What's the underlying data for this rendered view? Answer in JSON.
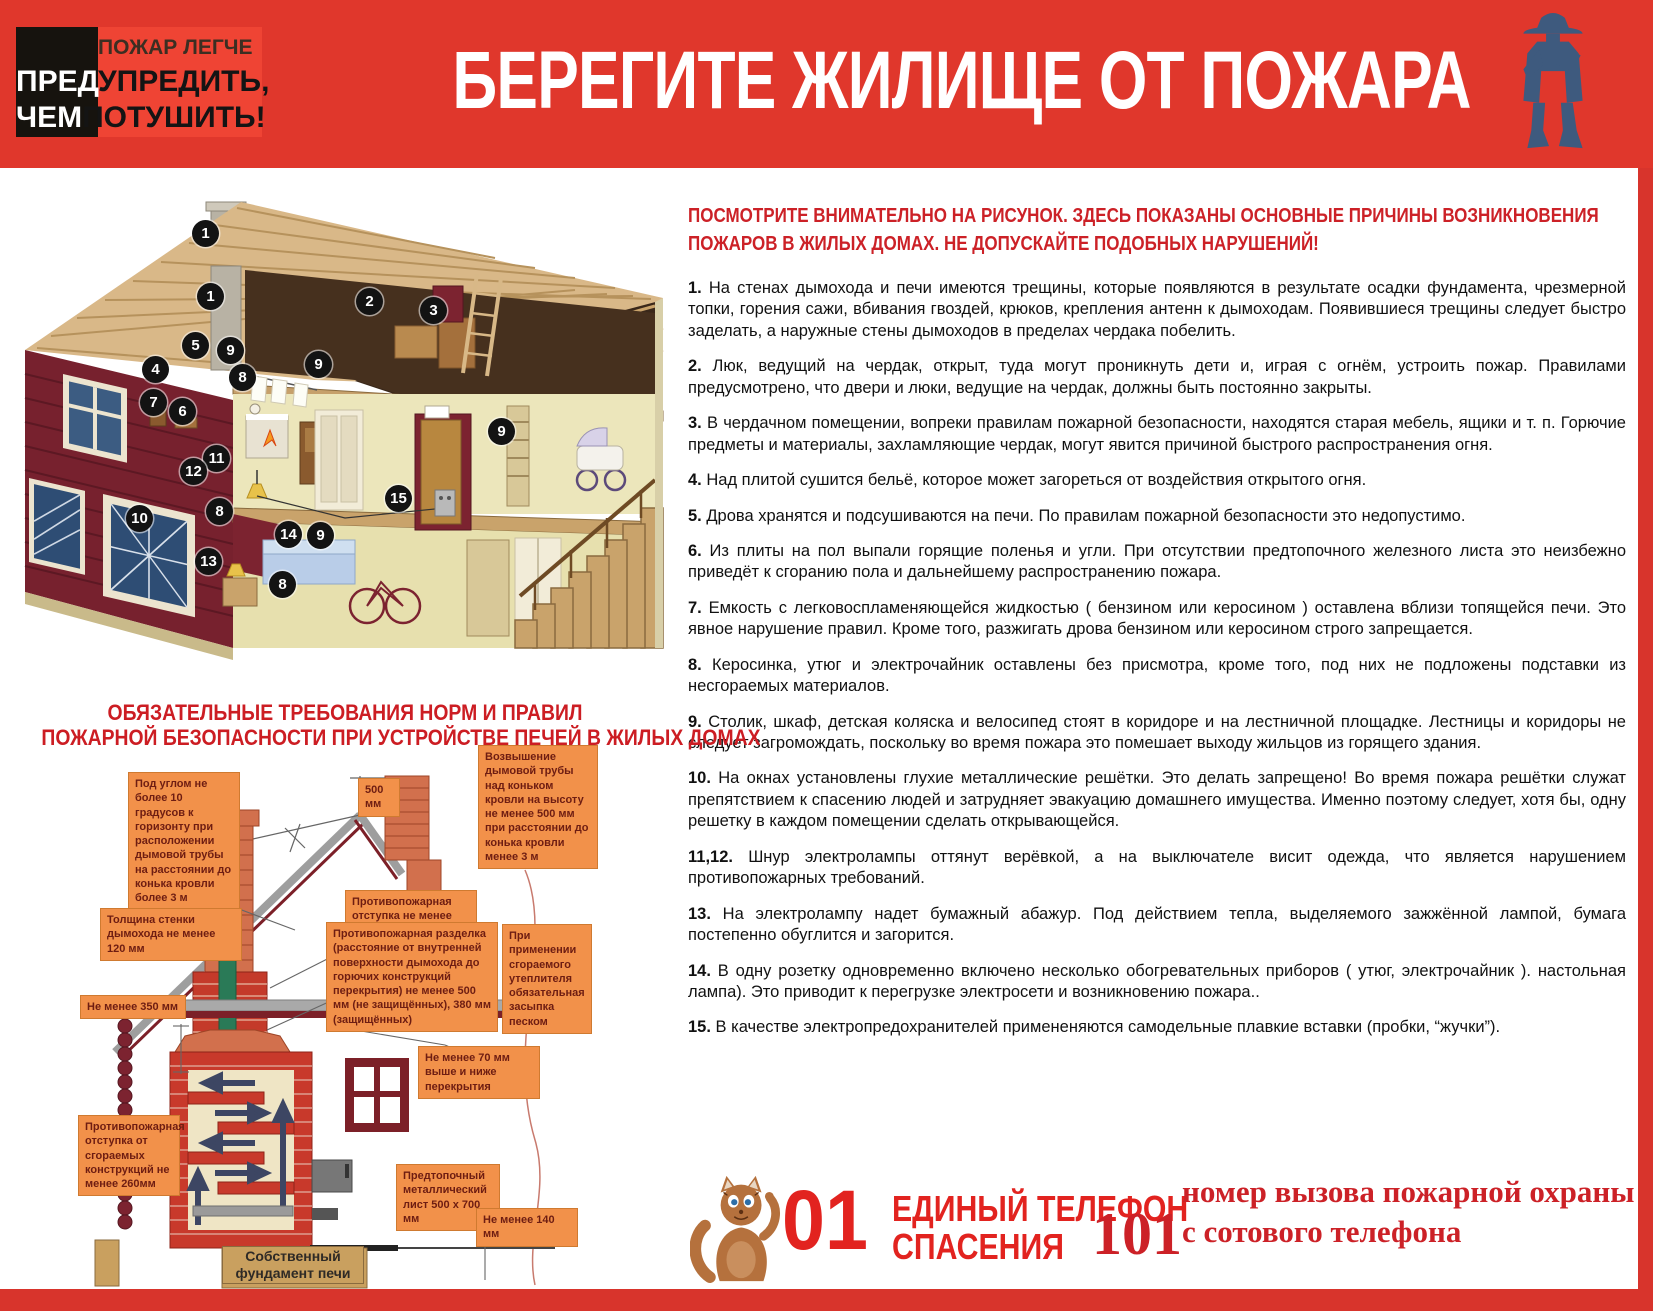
{
  "colors": {
    "header_red": "#e0372c",
    "accent_red": "#d8342c",
    "badge_light_red": "#ef4434",
    "badge_black": "#16130e",
    "heading_red": "#cc1d23",
    "callout_orange": "#f2914a",
    "callout_text": "#6e1d12",
    "firefighter_blue": "#3e5a7e",
    "mascot_brown": "#b5713d"
  },
  "header": {
    "badge": {
      "line1": "ПОЖАР ЛЕГЧЕ",
      "line2_left": "ПРЕД",
      "line2_right": "УПРЕДИТЬ,",
      "line3_left": "ЧЕМ",
      "line3_right": "ПОТУШИТЬ!"
    },
    "title": "БЕРЕГИТЕ ЖИЛИЩЕ ОТ ПОЖАРА",
    "icon": "firefighter-icon"
  },
  "intro": "ПОСМОТРИТЕ ВНИМАТЕЛЬНО НА РИСУНОК. ЗДЕСЬ ПОКАЗАНЫ ОСНОВНЫЕ ПРИЧИНЫ ВОЗНИКНОВЕНИЯ ПОЖАРОВ В ЖИЛЫХ ДОМАХ. НЕ ДОПУСКАЙТЕ ПОДОБНЫХ НАРУШЕНИЙ!",
  "causes": [
    {
      "num": "1.",
      "text": "На стенах дымохода и печи имеются трещины, которые появляются в  результате осадки фундамента, чрезмерной топки,  горения сажи,  вбивания гвоздей, крюков,  крепления антенн к дымоходам.   Появившиеся трещины  следует  быстро заделать, а наружные  стены  дымоходов  в  пределах  чердака  побелить."
    },
    {
      "num": "2.",
      "text": "Люк,  ведущий  на чердак,  открыт, туда могут проникнуть дети и, играя с огнём, устроить  пожар.   Правилами предусмотрено, что двери и люки, ведущие на чердак, должны быть постоянно закрыты."
    },
    {
      "num": "3.",
      "text": "В чердачном помещении, вопреки правилам пожарной безопасности, находятся старая мебель, ящики и т. п. Горючие предметы и материалы,  захламляющие чердак,  могут явится  причиной  быстрого  распространения огня."
    },
    {
      "num": "4.",
      "text": "Над плитой сушится бельё, которое может загореться от воздействия открытого огня."
    },
    {
      "num": "5.",
      "text": "Дрова хранятся и подсушиваются  на печи.  По правилам пожарной безопасности это недопустимо."
    },
    {
      "num": "6.",
      "text": "Из  плиты  на  пол  выпали  горящие  поленья  и  угли.   При  отсутствии   предтопочного  железного  листа  это неизбежно приведёт к сгоранию пола и дальнейшему распространению пожара."
    },
    {
      "num": "7.",
      "text": "Емкость  с легковоспламеняющейся  жидкостью  ( бензином или керосином )  оставлена  вблизи топящейся печи. Это явное нарушение правил. Кроме того, разжигать дрова бензином или керосином строго запрещается."
    },
    {
      "num": "8.",
      "text": "Керосинка, утюг и электрочайник оставлены без присмотра, кроме того, под них не подложены подставки из несгораемых материалов."
    },
    {
      "num": "9.",
      "text": "Столик,  шкаф,  детская  коляска  и  велосипед  стоят  в  коридоре  и  на  лестничной  площадке.  Лестницы  и коридоры  не  следует  загромождать, поскольку во время пожара это помешает выходу жильцов из горящего здания."
    },
    {
      "num": "10.",
      "text": "На  окнах  установлены  глухие  металлические  решётки.  Это делать запрещено!  Во время пожара  решётки служат  препятствием к  спасению  людей  и  затрудняет  эвакуацию  домашнего  имущества.   Именно поэтому следует, хотя бы,  одну решетку в каждом помещении сделать открывающейся."
    },
    {
      "num": "11,12.",
      "text": "Шнур  электролампы  оттянут  верёвкой,  а  на  выключателе  висит  одежда,  что  является  нарушением противопожарных требований."
    },
    {
      "num": "13.",
      "text": "На электролампу надет бумажный абажур. Под действием тепла, выделяемого зажжённой лампой, бумага постепенно обуглится и загорится."
    },
    {
      "num": "14.",
      "text": "В  одну  розетку   одновременно  включено  несколько   обогревательных  приборов ( утюг,   электрочайник ). настольная лампа). Это приводит к перегрузке электросети и возникновению пожара.."
    },
    {
      "num": "15.",
      "text": "В качестве электропредохранителей примененяются самодельные плавкие вставки (пробки, “жучки”)."
    }
  ],
  "house": {
    "markers": [
      {
        "n": "1",
        "x": 190,
        "y": 55
      },
      {
        "n": "1",
        "x": 195,
        "y": 118
      },
      {
        "n": "2",
        "x": 354,
        "y": 123
      },
      {
        "n": "3",
        "x": 418,
        "y": 132
      },
      {
        "n": "5",
        "x": 180,
        "y": 167
      },
      {
        "n": "9",
        "x": 215,
        "y": 172
      },
      {
        "n": "4",
        "x": 140,
        "y": 191
      },
      {
        "n": "9",
        "x": 303,
        "y": 186
      },
      {
        "n": "8",
        "x": 227,
        "y": 199
      },
      {
        "n": "7",
        "x": 138,
        "y": 224
      },
      {
        "n": "6",
        "x": 167,
        "y": 233
      },
      {
        "n": "9",
        "x": 486,
        "y": 253
      },
      {
        "n": "11",
        "x": 201,
        "y": 280
      },
      {
        "n": "12",
        "x": 178,
        "y": 293
      },
      {
        "n": "15",
        "x": 383,
        "y": 320
      },
      {
        "n": "8",
        "x": 204,
        "y": 333
      },
      {
        "n": "10",
        "x": 124,
        "y": 340
      },
      {
        "n": "14",
        "x": 273,
        "y": 356
      },
      {
        "n": "9",
        "x": 305,
        "y": 357
      },
      {
        "n": "13",
        "x": 193,
        "y": 383
      },
      {
        "n": "8",
        "x": 267,
        "y": 406
      }
    ]
  },
  "stove_section": {
    "heading_line1": "ОБЯЗАТЕЛЬНЫЕ ТРЕБОВАНИЯ НОРМ И ПРАВИЛ",
    "heading_line2": "ПОЖАРНОЙ БЕЗОПАСНОСТИ ПРИ УСТРОЙСТВЕ ПЕЧЕЙ В ЖИЛЫХ ДОМАХ",
    "callouts": [
      {
        "text": "Под углом не более 10 градусов к горизонту при расположении дымовой трубы на расстоянии до конька кровли более 3 м",
        "x": 128,
        "y": 772,
        "w": 112
      },
      {
        "text": "500 мм",
        "x": 358,
        "y": 778,
        "w": 42
      },
      {
        "text": "Возвышение дымовой трубы над коньком кровли на высоту не менее 500 мм при расстоянии до конька кровли менее 3 м",
        "x": 478,
        "y": 745,
        "w": 120
      },
      {
        "text": "Толщина стенки дымохода не менее 120 мм",
        "x": 100,
        "y": 908,
        "w": 142
      },
      {
        "text": "Противопожарная отступка не менее 130мм",
        "x": 345,
        "y": 890,
        "w": 132
      },
      {
        "text": "Противопожарная разделка (расстояние от внутренней поверхности дымохода до горючих конструкций перекрытия) не менее 500 мм (не защищённых), 380 мм (защищённых)",
        "x": 326,
        "y": 922,
        "w": 172
      },
      {
        "text": "При применении сгораемого утеплителя обязательная засыпка песком",
        "x": 502,
        "y": 924,
        "w": 90
      },
      {
        "text": "Не менее 350 мм",
        "x": 80,
        "y": 995,
        "w": 106
      },
      {
        "text": "Не менее 70 мм выше и ниже перекрытия",
        "x": 418,
        "y": 1046,
        "w": 122
      },
      {
        "text": "Противопожарная отступка от сгораемых конструкций не менее 260мм",
        "x": 78,
        "y": 1115,
        "w": 102
      },
      {
        "text": "Предтопочный металлический лист 500 x 700 мм",
        "x": 396,
        "y": 1164,
        "w": 104
      },
      {
        "text": "Не менее 140 мм",
        "x": 476,
        "y": 1208,
        "w": 102
      }
    ],
    "foundation_label": "Собственный фундамент печи"
  },
  "emergency": {
    "number_01": "01",
    "line1": "ЕДИНЫЙ ТЕЛЕФОН",
    "line2": "СПАСЕНИЯ",
    "number_101": "101",
    "note": "номер вызова пожарной охраны с сотового телефона"
  }
}
